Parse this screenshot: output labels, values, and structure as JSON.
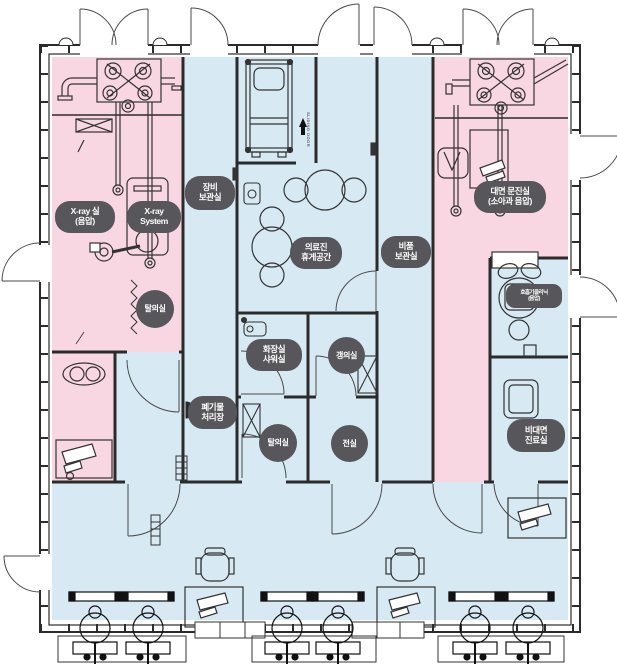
{
  "title": "음압 모듈형 클리닉 평면도",
  "colors": {
    "room_pink": "#f8d7e3",
    "room_blue": "#d7e9f3",
    "badge_bg": "#57575b",
    "badge_text": "#ffffff",
    "wall": "#2b2b2b"
  },
  "badges": [
    {
      "id": "xray-room",
      "lines": [
        "X-ray 실",
        "(음압)"
      ]
    },
    {
      "id": "xray-system",
      "lines": [
        "X-ray",
        "System"
      ]
    },
    {
      "id": "equipment-storage",
      "lines": [
        "장비",
        "보관실"
      ]
    },
    {
      "id": "staff-lounge",
      "lines": [
        "의료진",
        "휴게공간"
      ]
    },
    {
      "id": "supplies-storage",
      "lines": [
        "비품",
        "보관실"
      ]
    },
    {
      "id": "consultation-room",
      "lines": [
        "대면 문진실",
        "(소아과 음압)"
      ]
    },
    {
      "id": "dressing-upper",
      "lines": [
        "탈의실"
      ]
    },
    {
      "id": "respiratory-clinic",
      "lines": [
        "호흡기클리닉",
        "(음압)"
      ]
    },
    {
      "id": "toilet-shower",
      "lines": [
        "화장실",
        "샤워실"
      ]
    },
    {
      "id": "changing-room",
      "lines": [
        "갱의실"
      ]
    },
    {
      "id": "waste-disposal",
      "lines": [
        "폐기물",
        "처리장"
      ]
    },
    {
      "id": "dressing-lower",
      "lines": [
        "탈의실"
      ]
    },
    {
      "id": "anteroom",
      "lines": [
        "전실"
      ]
    },
    {
      "id": "remote-care",
      "lines": [
        "비대면",
        "진료실"
      ]
    }
  ],
  "annotations": {
    "sliding_door": "SLIDING DOOR"
  }
}
